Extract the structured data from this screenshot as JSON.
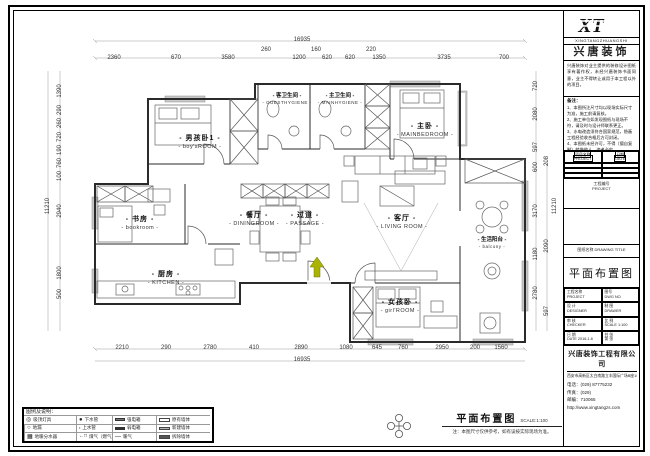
{
  "doc": {
    "drawing_title": "平面布置图",
    "scale": "SCALE:1:100",
    "footer_note": "注：本图尺寸仅供参考，如有误按实际现场为准。"
  },
  "colors": {
    "paper": "#ffffff",
    "line": "#222222",
    "wall_hatch": "#c9c9c9",
    "entry_arrow": "#aab400"
  },
  "rooms": [
    {
      "cn": "男孩卧1",
      "en": "boy'sROOM"
    },
    {
      "cn": "客卫生间",
      "en": "GUESTHYGIENE"
    },
    {
      "cn": "主卫生间",
      "en": "MAINHYGIENE"
    },
    {
      "cn": "主卧",
      "en": "MAINBEDROOM"
    },
    {
      "cn": "书房",
      "en": "bookroom"
    },
    {
      "cn": "餐厅",
      "en": "DININGROOM"
    },
    {
      "cn": "过道",
      "en": "PASSAGE"
    },
    {
      "cn": "客厅",
      "en": "LIVING ROOM"
    },
    {
      "cn": "生活阳台",
      "en": "balcony"
    },
    {
      "cn": "厨房",
      "en": "KITCHEN"
    },
    {
      "cn": "女孩卧",
      "en": "girl'ROOM"
    }
  ],
  "dims": {
    "top_overall": "16935",
    "top_small": [
      "260",
      "160",
      "220"
    ],
    "top": [
      "2360",
      "670",
      "3580",
      "1200",
      "620",
      "620",
      "1350",
      "3735",
      "700"
    ],
    "bottom": [
      "2210",
      "290",
      "2780",
      "410",
      "2890",
      "1080",
      "645",
      "760",
      "2950",
      "200",
      "1560"
    ],
    "bottom_overall": "16935",
    "left": [
      "1390",
      "290",
      "260",
      "720",
      "190",
      "760",
      "100",
      "2940",
      "1800",
      "500"
    ],
    "left_overall": "11210",
    "right_inner": [
      "720",
      "2080",
      "597",
      "600",
      "3170",
      "1180",
      "2780"
    ],
    "right_outer": [
      "208",
      "2090",
      "597"
    ],
    "right_overall": "11210"
  },
  "legend": {
    "header": "图例及说明：",
    "items": [
      {
        "label": "吸顶灯具"
      },
      {
        "label": "下水管"
      },
      {
        "label": "强电箱"
      },
      {
        "label": "原有墙体"
      },
      {
        "label": "地漏"
      },
      {
        "label": "上水管"
      },
      {
        "label": "弱电箱"
      },
      {
        "label": "新建墙体"
      },
      {
        "label": "地暖分水器"
      },
      {
        "label": "煤气（燃气）表"
      },
      {
        "label": "暖气"
      },
      {
        "label": "拆除墙体"
      }
    ]
  },
  "titleblock": {
    "logo": "XT",
    "logo_sub": "XINGTANGZHUANGSHI",
    "brand": "兴唐装饰",
    "disclaimer": "兴唐装饰对业主提供的装修设计图纸享有著作权，未经兴唐装饰书面同意，业主不得转让或用于本工程以外的项目。",
    "notes_header": "备注：",
    "notes": [
      "1、本图所注尺寸均以现场实际尺寸为准，施工前请复核。",
      "2、施工单位如发现图纸与现场不符，请及时与设计师联系更正。",
      "3、水电改造须符合国家规范，隐蔽工程经验收合格后方可封闭。",
      "4、本图纸未经许可，不得（擅自复制）转借他人，违者必究。"
    ],
    "t1": {
      "c1a": "项目名称",
      "c1b": "PROJECT",
      "c2a": "日期",
      "c2b": "DATE"
    },
    "project_no_cn": "工程编号",
    "project_no_en": "PROJECT",
    "drawing_name_label": "图纸名称 DRAWING TITLE",
    "drawing_title": "平面布置图",
    "t2": [
      [
        "工程名称",
        "PROJECT",
        "图号",
        "DWG NO."
      ],
      [
        "设 计",
        "DESIGNER",
        "制 图",
        "DRAWER"
      ],
      [
        "审 核",
        "CHECKER",
        "比 例",
        "SCALE 1:100"
      ],
      [
        "日 期",
        "DATE  2016.1.8",
        "共  张",
        "第  张"
      ]
    ],
    "company": {
      "name": "兴唐装饰工程有限公司",
      "address": "西安市高新区太白南路立丰国际广场B座1004室",
      "phone": "电话：(029) 87775232",
      "fax": "传真：(029)",
      "zip": "邮编：710065",
      "url": "http://www.xingtangzs.com"
    }
  }
}
